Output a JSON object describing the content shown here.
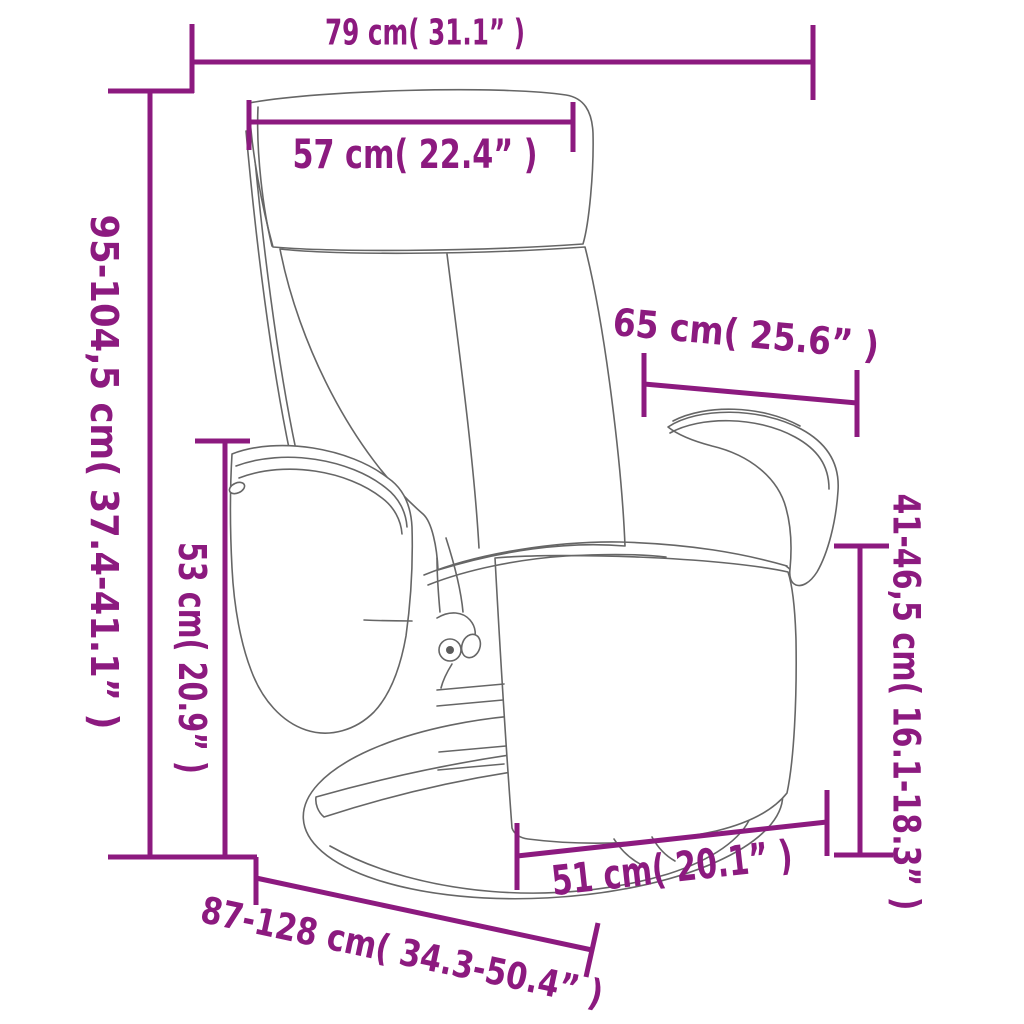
{
  "diagram": {
    "subject": "recliner-chair-with-footrest-dimension-drawing",
    "style": {
      "accent_color": "#8C1A7F",
      "drawing_line_color": "#666666",
      "background_color": "#FFFFFF"
    },
    "dimensions": {
      "top_width": {
        "label": "79 cm( 31.1” )"
      },
      "headrest_width": {
        "label": "57 cm( 22.4” )"
      },
      "total_height": {
        "label": "95-104,5 cm( 37.4-41.1” )"
      },
      "armrest_floor_height": {
        "label": "53 cm( 20.9” )"
      },
      "backrest_depth": {
        "label": "65 cm( 25.6” )"
      },
      "seat_floor_height": {
        "label": "41-46,5 cm( 16.1-18.3” )"
      },
      "seat_width": {
        "label": "51 cm( 20.1” )"
      },
      "total_depth": {
        "label": "87-128 cm( 34.3-50.4” )"
      }
    }
  }
}
